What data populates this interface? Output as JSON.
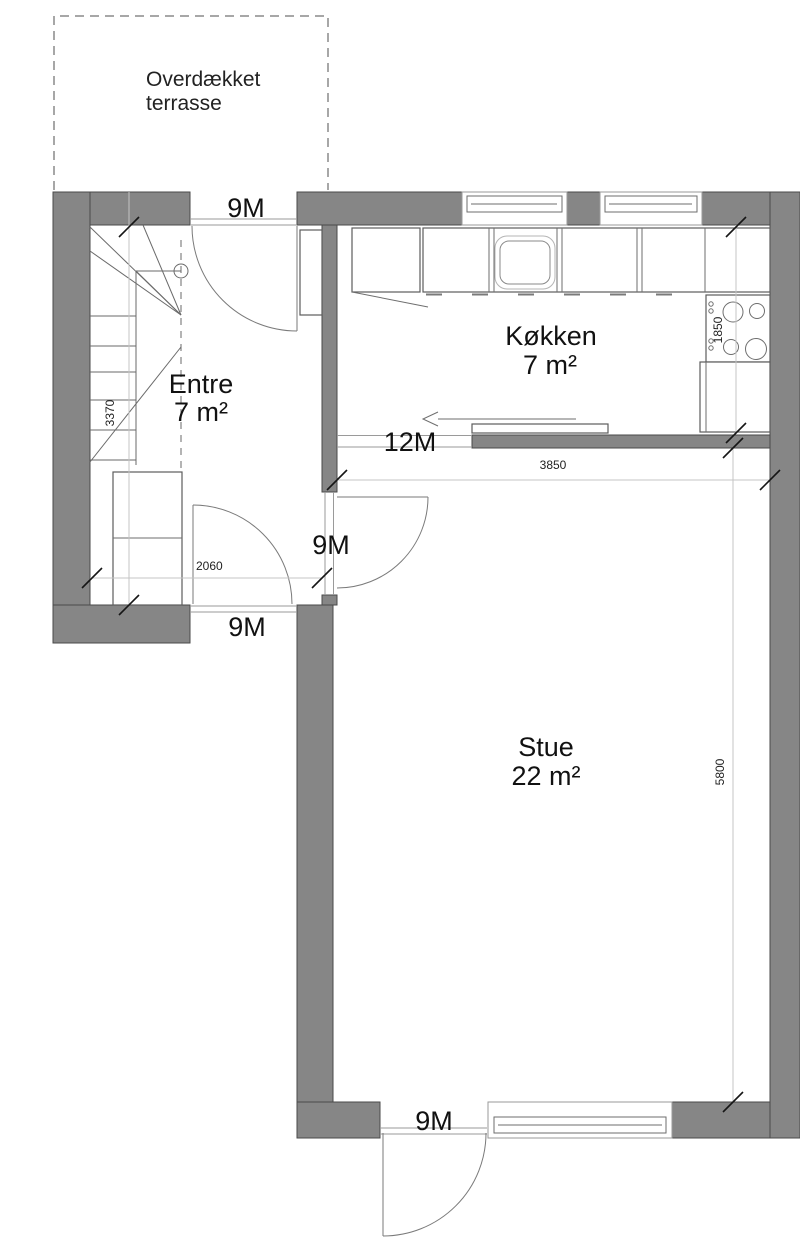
{
  "plan": {
    "terrace": {
      "label_line1": "Overdækket",
      "label_line2": "terrasse"
    },
    "rooms": [
      {
        "name": "Entre",
        "area": "7 m²"
      },
      {
        "name": "Køkken",
        "area": "7 m²"
      },
      {
        "name": "Stue",
        "area": "22 m²"
      }
    ],
    "module_labels": {
      "terrace_door": "9M",
      "entre_exterior_door": "9M",
      "entre_stue_door": "9M",
      "kitchen_stue_opening": "12M",
      "stue_exterior_door": "9M"
    },
    "dimensions": {
      "entre_depth": "3370",
      "entre_width": "2060",
      "kitchen_depth": "1850",
      "stue_width": "3850",
      "stue_depth": "5800"
    },
    "colors": {
      "wall": "#868686",
      "outline": "#4a4a4a"
    }
  }
}
